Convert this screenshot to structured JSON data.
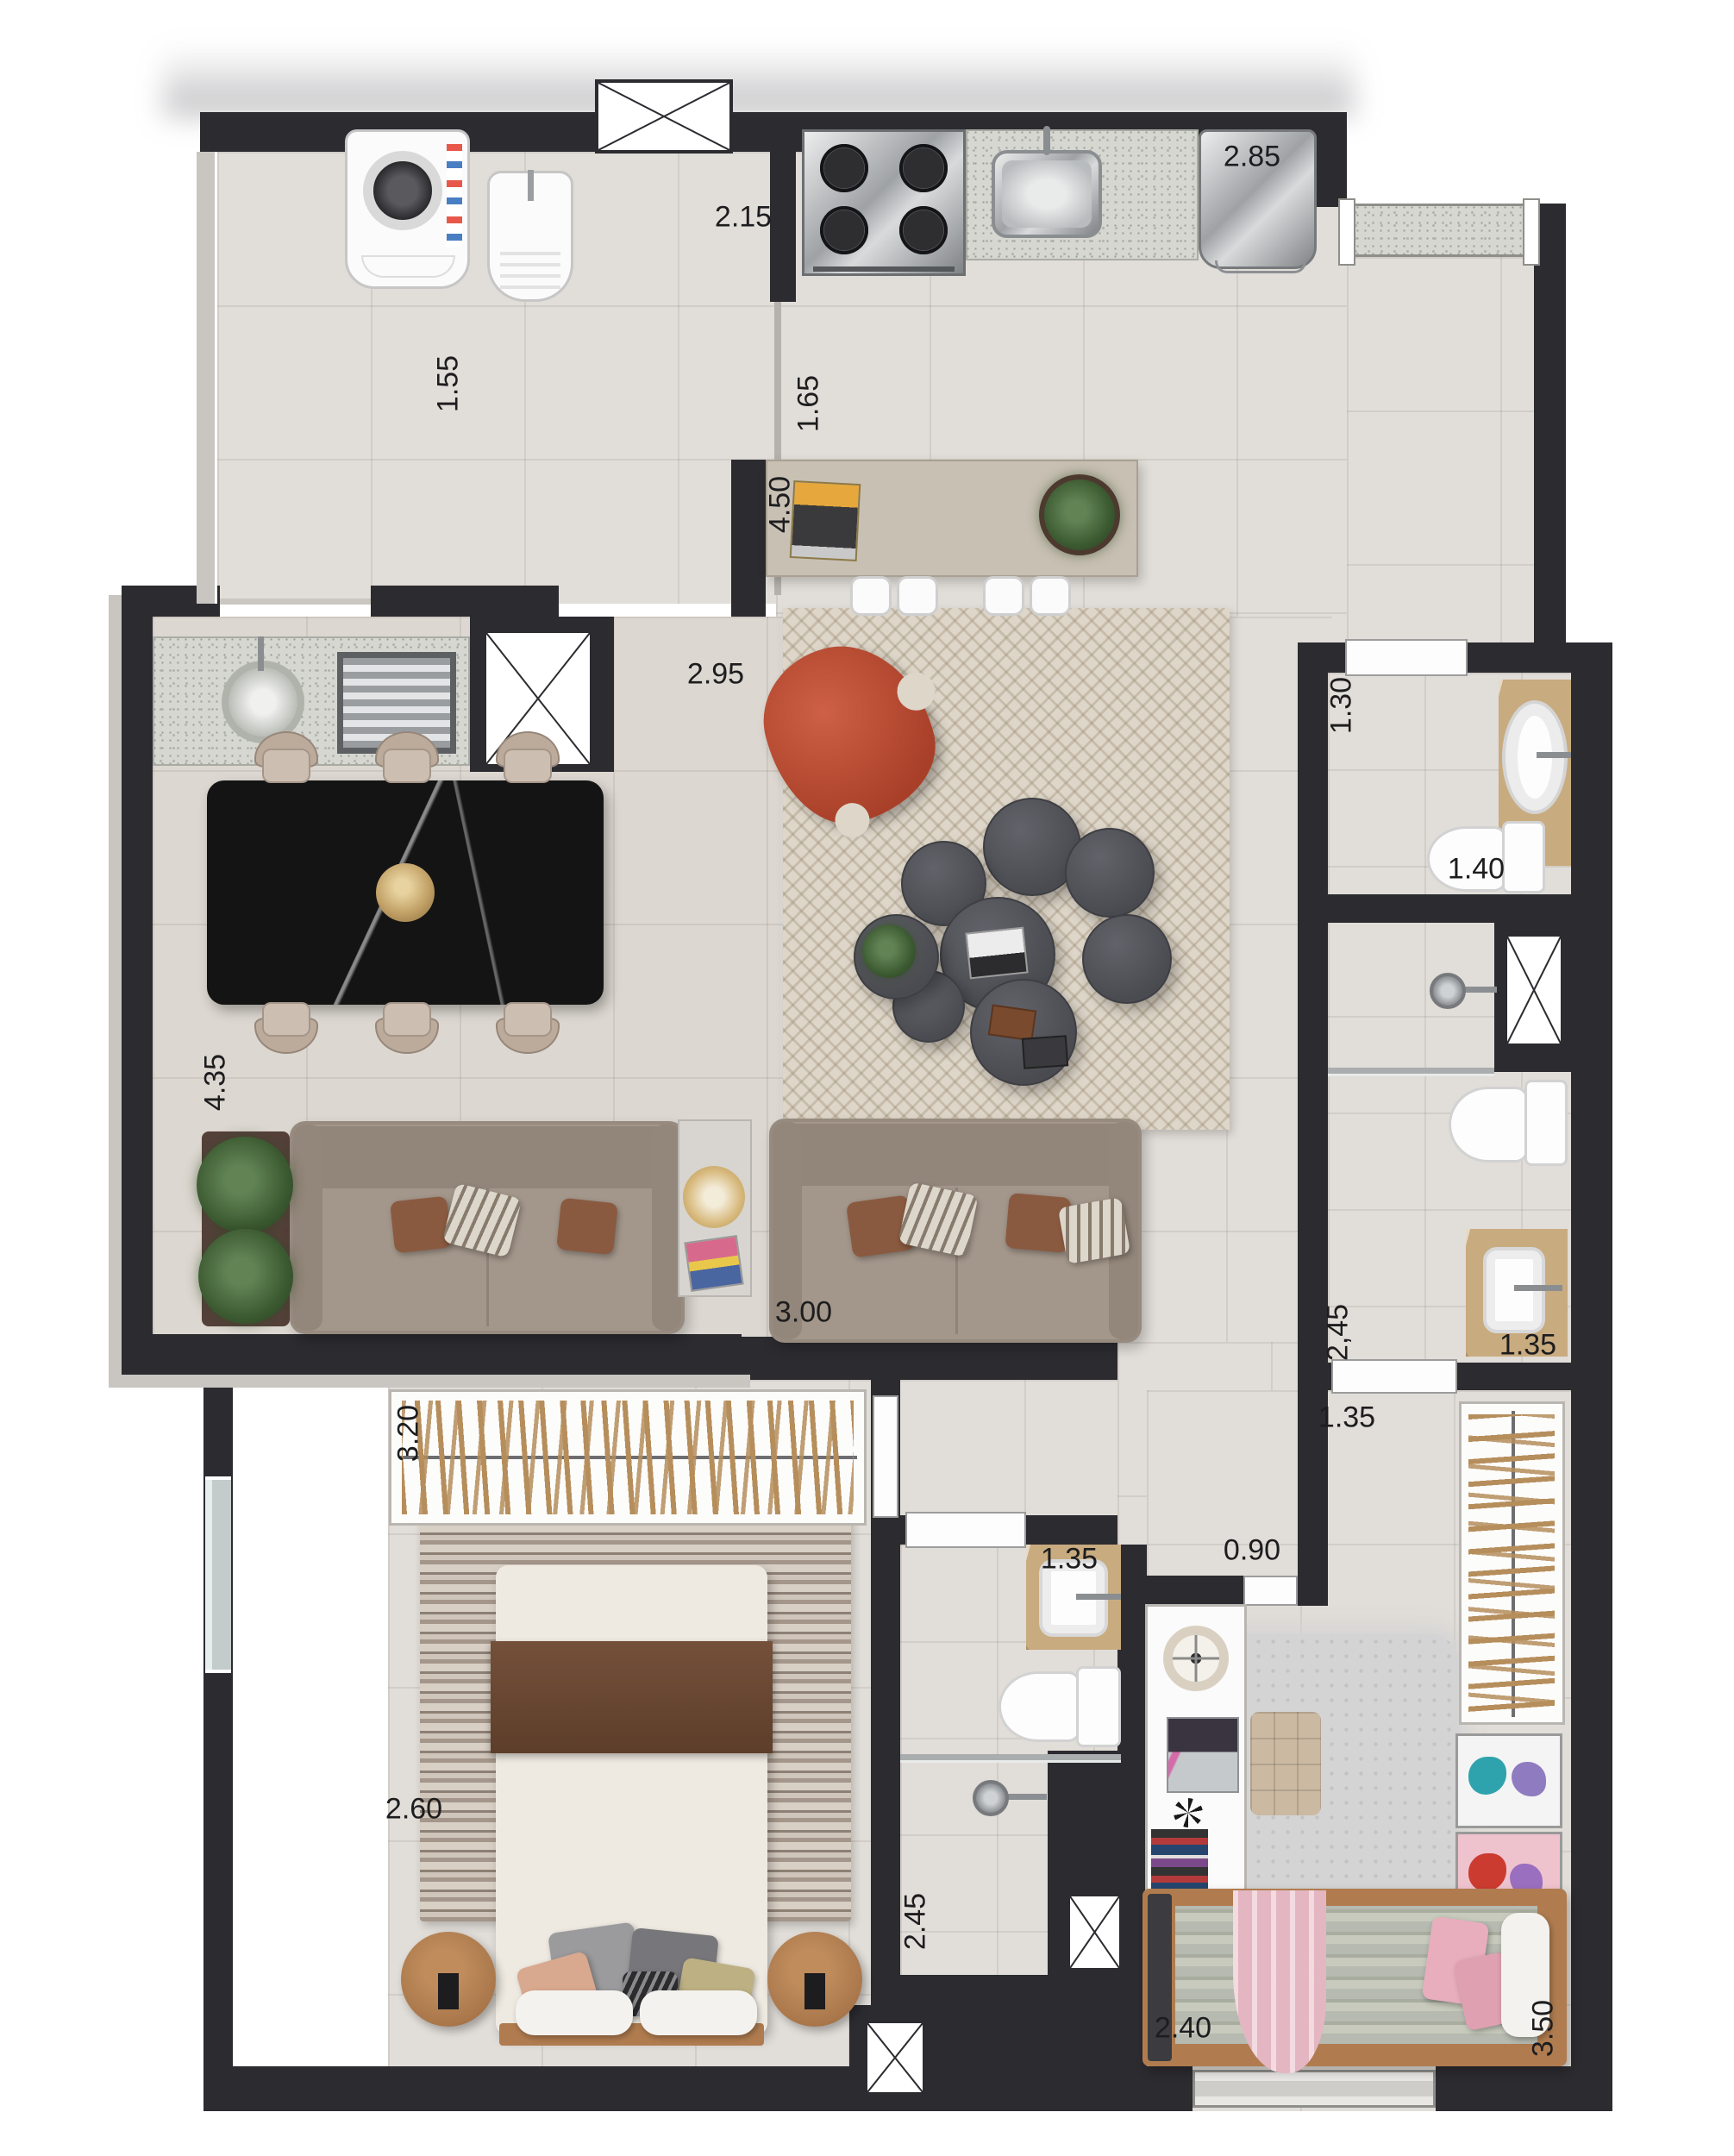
{
  "floor_plan": {
    "dimensions": {
      "laundry_width": "2.15",
      "kitchen_width": "2.85",
      "service_passage": "1.55",
      "kitchen_aisle": "1.65",
      "island_length": "4.50",
      "dining_width": "2.95",
      "lavabo_width": "1.30",
      "lavabo_length": "1.40",
      "balcony_length": "4.35",
      "living_width": "3.00",
      "closet_length": "3.20",
      "suite_bath_length": "2,45",
      "suite_bath_width": "1.35",
      "hall_width": "1.35",
      "hall_door": "0.90",
      "social_bath_width": "1.35",
      "master_bedroom_width": "2.60",
      "social_bath_length": "2.45",
      "kids_bedroom_width": "2.40",
      "kids_bedroom_length": "3.50"
    }
  }
}
